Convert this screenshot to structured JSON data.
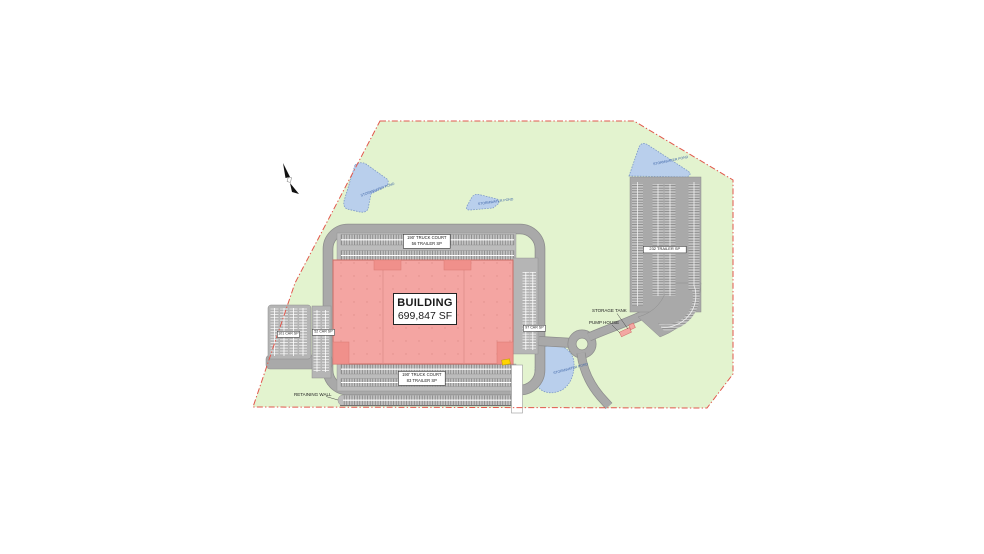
{
  "plan": {
    "building": {
      "title": "BUILDING",
      "area": "699,847 SF"
    },
    "truck_court_north": {
      "line1": "190' TRUCK COURT",
      "line2": "56 TRAILER SP"
    },
    "truck_court_south": {
      "line1": "190' TRUCK COURT",
      "line2": "83 TRAILER SP"
    },
    "parking_west": "101 CAR SP",
    "parking_west_narrow": "52 CAR SP",
    "parking_east": "97 CAR SP",
    "trailer_lot": "232 TRAILER SP",
    "storage_tank": "STORAGE TANK",
    "pump_house": "PUMP HOUSE",
    "retaining_wall": "RETAINING WALL",
    "pond_label": "STORMWATER POND",
    "icons": {
      "north_arrow": "north-arrow-icon"
    },
    "colors": {
      "site_green": "#e3f3cf",
      "boundary_red": "#e2574c",
      "road_gray": "#a9a9a9",
      "pavement_light": "#c3c3c3",
      "building_pink": "#f4a5a2",
      "building_accent": "#f0908b",
      "pond_blue": "#b9cfec",
      "marker_yellow": "#ffd400"
    }
  }
}
